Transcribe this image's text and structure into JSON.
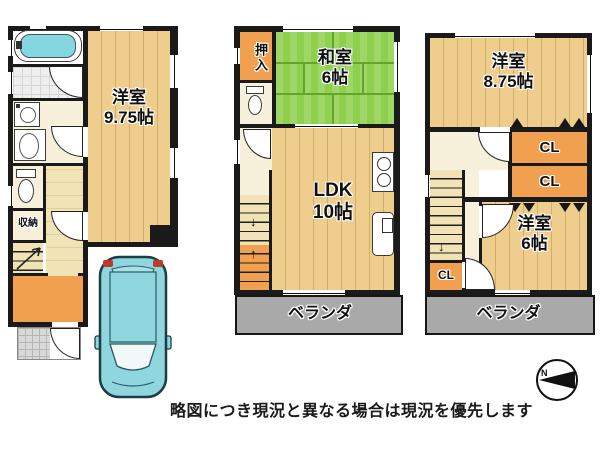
{
  "disclaimer": "略図につき現況と異なる場合は現況を優先します",
  "compass": {
    "north": "N"
  },
  "icons": {
    "up_arrow": "↑",
    "down_arrow": "↓"
  },
  "floor1": {
    "room": {
      "name": "洋室",
      "size": "9.75帖"
    },
    "storage": "収納"
  },
  "floor2": {
    "closet": "押入",
    "tatami_room": {
      "name": "和室",
      "size": "6帖"
    },
    "ldk": {
      "name": "LDK",
      "size": "10帖"
    },
    "veranda": "ベランダ"
  },
  "floor3": {
    "room_large": {
      "name": "洋室",
      "size": "8.75帖"
    },
    "closets": {
      "cl1": "CL",
      "cl2": "CL",
      "cl3": "CL"
    },
    "room_small": {
      "name": "洋室",
      "size": "6帖"
    },
    "veranda": "ベランダ"
  },
  "colors": {
    "wall": "#1a1a1a",
    "floor_tan": "#eecd8d",
    "tatami_green": "#8ed04e",
    "closet_orange": "#f0a04e",
    "veranda_gray": "#a9a9a9",
    "car_cyan": "#8fd6de"
  }
}
